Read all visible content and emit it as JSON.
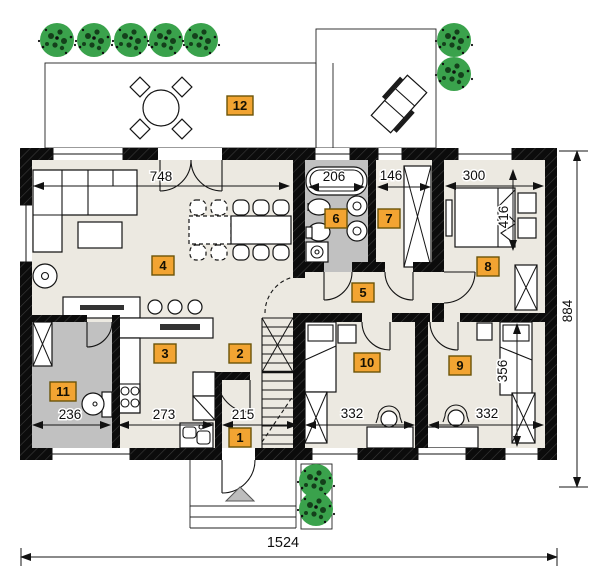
{
  "rooms": [
    {
      "number": "1"
    },
    {
      "number": "2"
    },
    {
      "number": "3"
    },
    {
      "number": "4"
    },
    {
      "number": "5"
    },
    {
      "number": "6"
    },
    {
      "number": "7"
    },
    {
      "number": "8"
    },
    {
      "number": "9"
    },
    {
      "number": "10"
    },
    {
      "number": "11"
    },
    {
      "number": "12"
    }
  ],
  "dimensions": {
    "living_width": "748",
    "bathtub": "206",
    "closet_width": "146",
    "bedroom8_width": "300",
    "bedroom8_depth": "416",
    "building_depth": "884",
    "wc_width": "236",
    "kitchen_width": "273",
    "hall_width": "215",
    "bedroom10_width": "332",
    "bedroom9_width": "332",
    "bedroom9_depth": "356",
    "building_width": "1524"
  },
  "colors": {
    "wall": "#111111",
    "floor": "#ECE9E1",
    "wet_floor": "#C1C1C1",
    "label_bg": "#F2A432",
    "label_border": "#6B5408",
    "tree": "#3AA24C",
    "tree_dark": "#14401B",
    "entry_triangle": "#BDBDBD"
  }
}
